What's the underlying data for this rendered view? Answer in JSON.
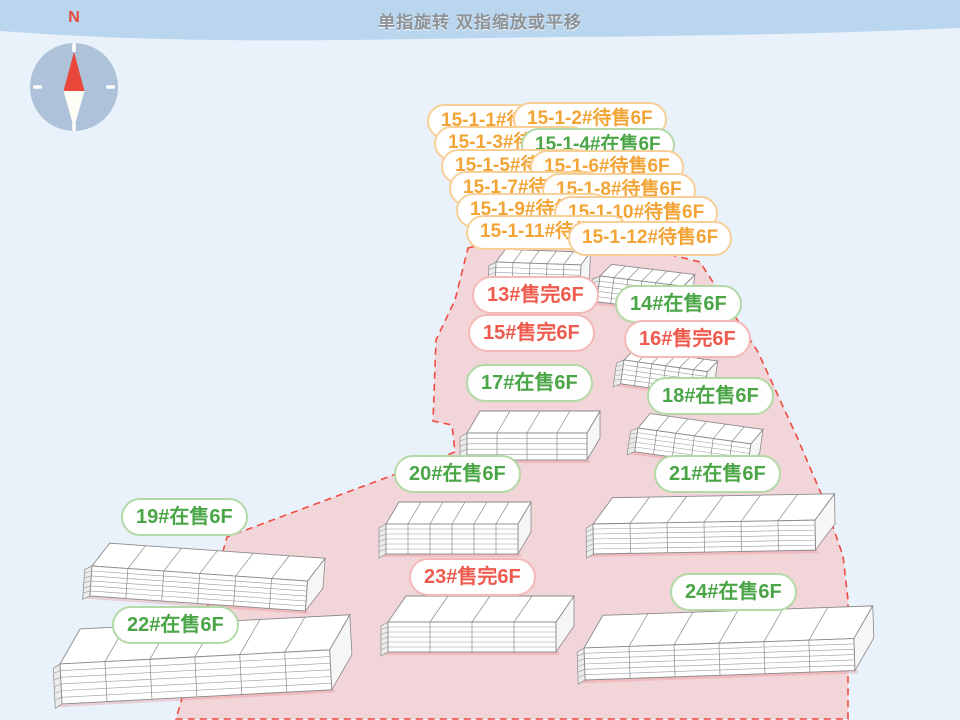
{
  "header": {
    "title": "单指旋转 双指缩放或平移"
  },
  "compass": {
    "north_label": "N"
  },
  "colors": {
    "background": "#e9f1fb",
    "top_bar": "#b9d6ee",
    "site_fill": "#f2d5d9",
    "boundary_red": "#ef4b40",
    "on_sale_text": "#4aa546",
    "sold_out_text": "#ef5a4e",
    "pending_text": "#f3a437",
    "compass_disc": "#aec3da",
    "needle_red": "#e8473a"
  },
  "building_labels": [
    {
      "id": "15-1-1",
      "text": "15-1-1#待售6F",
      "status": "待售",
      "style": "pending",
      "small": true,
      "x": 427,
      "y": 104
    },
    {
      "id": "15-1-2",
      "text": "15-1-2#待售6F",
      "status": "待售",
      "style": "pending",
      "small": true,
      "x": 513,
      "y": 102
    },
    {
      "id": "15-1-3",
      "text": "15-1-3#待售6F",
      "status": "待售",
      "style": "pending",
      "small": true,
      "x": 434,
      "y": 126
    },
    {
      "id": "15-1-4",
      "text": "15-1-4#在售6F",
      "status": "在售",
      "style": "sale",
      "small": true,
      "x": 521,
      "y": 128
    },
    {
      "id": "15-1-5",
      "text": "15-1-5#待售6F",
      "status": "待售",
      "style": "pending",
      "small": true,
      "x": 441,
      "y": 149
    },
    {
      "id": "15-1-6",
      "text": "15-1-6#待售6F",
      "status": "待售",
      "style": "pending",
      "small": true,
      "x": 530,
      "y": 150
    },
    {
      "id": "15-1-7",
      "text": "15-1-7#待售6F",
      "status": "待售",
      "style": "pending",
      "small": true,
      "x": 449,
      "y": 171
    },
    {
      "id": "15-1-8",
      "text": "15-1-8#待售6F",
      "status": "待售",
      "style": "pending",
      "small": true,
      "x": 542,
      "y": 173
    },
    {
      "id": "15-1-9",
      "text": "15-1-9#待售6F",
      "status": "待售",
      "style": "pending",
      "small": true,
      "x": 456,
      "y": 193
    },
    {
      "id": "15-1-10",
      "text": "15-1-10#待售6F",
      "status": "待售",
      "style": "pending",
      "small": true,
      "x": 554,
      "y": 196
    },
    {
      "id": "15-1-11",
      "text": "15-1-11#待售6F",
      "status": "待售",
      "style": "pending",
      "small": true,
      "x": 466,
      "y": 215
    },
    {
      "id": "15-1-12",
      "text": "15-1-12#待售6F",
      "status": "待售",
      "style": "pending",
      "small": true,
      "x": 568,
      "y": 221
    },
    {
      "id": "13",
      "text": "13#售完6F",
      "status": "售完",
      "style": "sold",
      "small": false,
      "x": 472,
      "y": 276
    },
    {
      "id": "14",
      "text": "14#在售6F",
      "status": "在售",
      "style": "sale",
      "small": false,
      "x": 615,
      "y": 285
    },
    {
      "id": "15",
      "text": "15#售完6F",
      "status": "售完",
      "style": "sold",
      "small": false,
      "x": 468,
      "y": 314
    },
    {
      "id": "16",
      "text": "16#售完6F",
      "status": "售完",
      "style": "sold",
      "small": false,
      "x": 624,
      "y": 320
    },
    {
      "id": "17",
      "text": "17#在售6F",
      "status": "在售",
      "style": "sale",
      "small": false,
      "x": 466,
      "y": 364
    },
    {
      "id": "18",
      "text": "18#在售6F",
      "status": "在售",
      "style": "sale",
      "small": false,
      "x": 647,
      "y": 377
    },
    {
      "id": "19",
      "text": "19#在售6F",
      "status": "在售",
      "style": "sale",
      "small": false,
      "x": 121,
      "y": 498
    },
    {
      "id": "20",
      "text": "20#在售6F",
      "status": "在售",
      "style": "sale",
      "small": false,
      "x": 394,
      "y": 455
    },
    {
      "id": "21",
      "text": "21#在售6F",
      "status": "在售",
      "style": "sale",
      "small": false,
      "x": 654,
      "y": 455
    },
    {
      "id": "22",
      "text": "22#在售6F",
      "status": "在售",
      "style": "sale",
      "small": false,
      "x": 112,
      "y": 606
    },
    {
      "id": "23",
      "text": "23#售完6F",
      "status": "售完",
      "style": "sold",
      "small": false,
      "x": 409,
      "y": 558
    },
    {
      "id": "24",
      "text": "24#在售6F",
      "status": "在售",
      "style": "sale",
      "small": false,
      "x": 670,
      "y": 573
    }
  ],
  "scene": {
    "site_polygon": "468,248 500,240 560,238 610,246 660,252 700,262 758,352 797,437 823,498 843,556 848,600 848,719 176,719 182,698 227,537 455,452 452,425 433,421 436,340 455,300",
    "buildings": [
      {
        "name": "building-13",
        "x": 496,
        "y": 262,
        "rot": 2,
        "cols": 5,
        "seg": 17,
        "fh": 26,
        "floors": 4,
        "dx": 9,
        "dy": 13
      },
      {
        "name": "building-14",
        "x": 600,
        "y": 276,
        "rot": 7,
        "cols": 6,
        "seg": 14,
        "fh": 26,
        "floors": 4,
        "dx": 10,
        "dy": 13
      },
      {
        "name": "building-16",
        "x": 624,
        "y": 360,
        "rot": 8,
        "cols": 6,
        "seg": 14,
        "fh": 24,
        "floors": 4,
        "dx": 9,
        "dy": 12
      },
      {
        "name": "building-17",
        "x": 467,
        "y": 433,
        "rot": 0,
        "cols": 4,
        "seg": 30,
        "fh": 27,
        "floors": 4,
        "dx": 13,
        "dy": 22
      },
      {
        "name": "building-18",
        "x": 638,
        "y": 428,
        "rot": 8,
        "cols": 6,
        "seg": 19,
        "fh": 24,
        "floors": 4,
        "dx": 10,
        "dy": 16
      },
      {
        "name": "building-20",
        "x": 386,
        "y": 524,
        "rot": 0,
        "cols": 6,
        "seg": 22,
        "fh": 30,
        "floors": 5,
        "dx": 13,
        "dy": 22
      },
      {
        "name": "building-21",
        "x": 593,
        "y": 524,
        "rot": -1,
        "cols": 6,
        "seg": 37,
        "fh": 30,
        "floors": 5,
        "dx": 20,
        "dy": 26
      },
      {
        "name": "building-19",
        "x": 92,
        "y": 566,
        "rot": 4,
        "cols": 6,
        "seg": 36,
        "fh": 30,
        "floors": 5,
        "dx": 16,
        "dy": 24
      },
      {
        "name": "building-23",
        "x": 388,
        "y": 622,
        "rot": 0,
        "cols": 4,
        "seg": 42,
        "fh": 30,
        "floors": 5,
        "dx": 18,
        "dy": 26
      },
      {
        "name": "building-24",
        "x": 584,
        "y": 648,
        "rot": -2,
        "cols": 6,
        "seg": 45,
        "fh": 32,
        "floors": 5,
        "dx": 20,
        "dy": 32
      },
      {
        "name": "building-22",
        "x": 60,
        "y": 664,
        "rot": -3,
        "cols": 6,
        "seg": 45,
        "fh": 40,
        "floors": 5,
        "dx": 22,
        "dy": 34
      }
    ]
  }
}
